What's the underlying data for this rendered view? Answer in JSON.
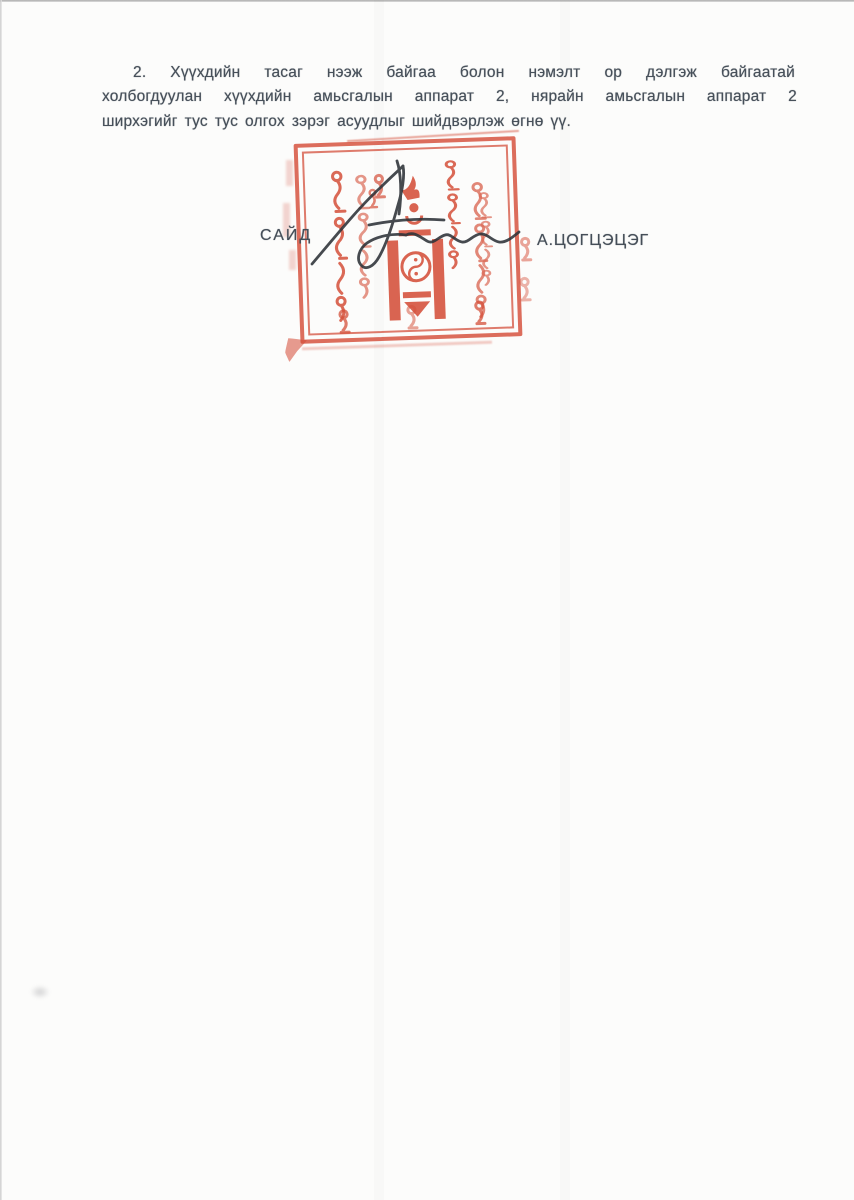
{
  "page": {
    "background_color": "#fcfcfb",
    "width_px": 854,
    "height_px": 1200
  },
  "document": {
    "ink_color": "#47505a",
    "paragraph": "2. Хүүхдийн тасаг нээж байгаа болон нэмэлт ор дэлгэж байгаатай холбогдуулан хүүхдийн амьсгалын аппарат 2, нярайн амьсгалын аппарат 2 ширхэгийг тус тус олгох зэрэг асуудлыг шийдвэрлэж өгнө үү.",
    "lines": [
      "2. Хүүхдийн тасаг нээж байгаа болон нэмэлт ор дэлгэж байгаатай",
      "холбогдуулан хүүхдийн амьсгалын аппарат 2, нярайн амьсгалын аппарат 2",
      "ширхэгийг тус тус олгох зэрэг асуудлыг шийдвэрлэж өгнө үү."
    ]
  },
  "signature_block": {
    "title": "САЙД",
    "name": "А.ЦОГЦЭЦЭГ"
  },
  "stamp": {
    "shape": "square-seal",
    "emblem": "soyombo",
    "script": "mongolian-vertical-script",
    "ink_color": "#d5503a"
  }
}
